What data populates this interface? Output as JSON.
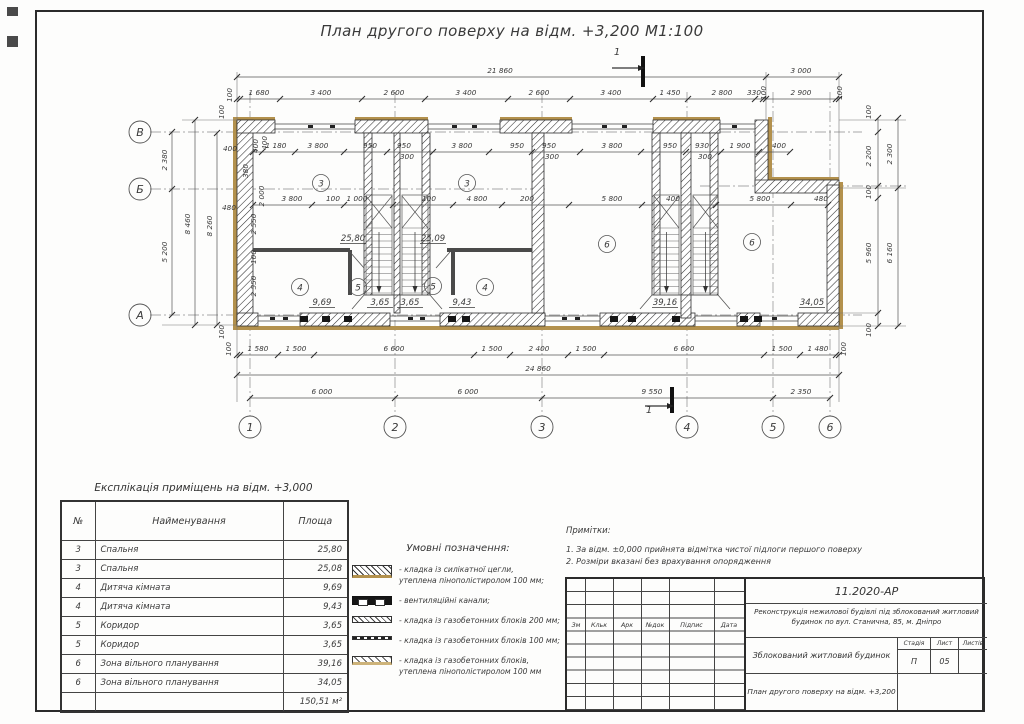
{
  "sheet": {
    "title": "План другого поверху на відм. +3,200 М1:100"
  },
  "plan": {
    "axes_bottom": [
      [
        "1",
        250
      ],
      [
        "2",
        395
      ],
      [
        "3",
        542
      ],
      [
        "4",
        687
      ],
      [
        "5",
        773
      ],
      [
        "6",
        830
      ]
    ],
    "axes_left": [
      [
        "В",
        132
      ],
      [
        "Б",
        189
      ],
      [
        "А",
        315
      ]
    ],
    "room_tags": [
      [
        "3",
        321,
        183
      ],
      [
        "3",
        467,
        183
      ],
      [
        "4",
        300,
        287
      ],
      [
        "5",
        358,
        287
      ],
      [
        "5",
        433,
        286
      ],
      [
        "4",
        485,
        287
      ],
      [
        "6",
        607,
        244
      ],
      [
        "6",
        752,
        242
      ]
    ],
    "area_labels": [
      [
        "25,80",
        353,
        241
      ],
      [
        "25,09",
        433,
        241
      ],
      [
        "9,69",
        322,
        305
      ],
      [
        "3,65",
        380,
        305
      ],
      [
        "3,65",
        410,
        305
      ],
      [
        "9,43",
        462,
        305
      ],
      [
        "39,16",
        665,
        305
      ],
      [
        "34,05",
        812,
        305
      ]
    ],
    "section_labels": [
      [
        "1",
        617,
        55
      ],
      [
        "1",
        649,
        413
      ]
    ],
    "dim_labels": [
      [
        "21 860",
        500,
        73,
        0
      ],
      [
        "3 000",
        801,
        73,
        0
      ],
      [
        "100",
        232,
        95,
        1
      ],
      [
        "1 680",
        259,
        95,
        0
      ],
      [
        "3 400",
        321,
        95,
        0
      ],
      [
        "2 600",
        394,
        95,
        0
      ],
      [
        "3 400",
        466,
        95,
        0
      ],
      [
        "2 600",
        539,
        95,
        0
      ],
      [
        "3 400",
        611,
        95,
        0
      ],
      [
        "1 450",
        670,
        95,
        0
      ],
      [
        "2 800",
        722,
        95,
        0
      ],
      [
        "330",
        754,
        95,
        0
      ],
      [
        "100",
        766,
        93,
        1
      ],
      [
        "2 900",
        801,
        95,
        0
      ],
      [
        "100",
        842,
        93,
        1
      ],
      [
        "400",
        258,
        146,
        1
      ],
      [
        "1 180",
        276,
        148,
        0
      ],
      [
        "3 800",
        318,
        148,
        0
      ],
      [
        "950",
        370,
        148,
        0
      ],
      [
        "950",
        404,
        148,
        0
      ],
      [
        "300",
        407,
        159,
        0
      ],
      [
        "3 800",
        462,
        148,
        0
      ],
      [
        "950",
        517,
        148,
        0
      ],
      [
        "950",
        549,
        148,
        0
      ],
      [
        "300",
        552,
        159,
        0
      ],
      [
        "3 800",
        612,
        148,
        0
      ],
      [
        "950",
        670,
        148,
        0
      ],
      [
        "930",
        702,
        148,
        0
      ],
      [
        "300",
        705,
        159,
        0
      ],
      [
        "1 900",
        740,
        148,
        0
      ],
      [
        "400",
        779,
        148,
        0
      ],
      [
        "3 800",
        292,
        201,
        0
      ],
      [
        "100",
        333,
        201,
        0
      ],
      [
        "1 000",
        357,
        201,
        0
      ],
      [
        "100",
        429,
        201,
        0
      ],
      [
        "4 800",
        477,
        201,
        0
      ],
      [
        "200",
        527,
        201,
        0
      ],
      [
        "5 800",
        612,
        201,
        0
      ],
      [
        "400",
        673,
        201,
        0
      ],
      [
        "5 800",
        760,
        201,
        0
      ],
      [
        "480",
        821,
        201,
        0
      ],
      [
        "100",
        231,
        349,
        1
      ],
      [
        "1 580",
        258,
        351,
        0
      ],
      [
        "1 500",
        296,
        351,
        0
      ],
      [
        "6 600",
        394,
        351,
        0
      ],
      [
        "1 500",
        492,
        351,
        0
      ],
      [
        "2 400",
        539,
        351,
        0
      ],
      [
        "1 500",
        586,
        351,
        0
      ],
      [
        "6 600",
        684,
        351,
        0
      ],
      [
        "1 500",
        782,
        351,
        0
      ],
      [
        "1 480",
        818,
        351,
        0
      ],
      [
        "100",
        846,
        349,
        1
      ],
      [
        "24 860",
        538,
        371,
        0
      ],
      [
        "6 000",
        322,
        394,
        0
      ],
      [
        "6 000",
        468,
        394,
        0
      ],
      [
        "9 550",
        652,
        394,
        0
      ],
      [
        "2 350",
        801,
        394,
        0
      ],
      [
        "2 380",
        167,
        160,
        1
      ],
      [
        "5 200",
        167,
        252,
        1
      ],
      [
        "8 460",
        190,
        224,
        1
      ],
      [
        "8 260",
        212,
        226,
        1
      ],
      [
        "100",
        224,
        112,
        1
      ],
      [
        "100",
        224,
        332,
        1
      ],
      [
        "400",
        230,
        151,
        0
      ],
      [
        "480",
        229,
        210,
        0
      ],
      [
        "2 550",
        256,
        224,
        1
      ],
      [
        "100",
        256,
        257,
        1
      ],
      [
        "2 550",
        256,
        286,
        1
      ],
      [
        "2 000",
        264,
        196,
        1
      ],
      [
        "380",
        248,
        171,
        1
      ],
      [
        "400",
        267,
        143,
        1
      ],
      [
        "100",
        871,
        112,
        1
      ],
      [
        "2 200",
        871,
        156,
        1
      ],
      [
        "2 300",
        892,
        154,
        1
      ],
      [
        "100",
        871,
        192,
        1
      ],
      [
        "5 960",
        871,
        253,
        1
      ],
      [
        "6 160",
        892,
        253,
        1
      ],
      [
        "100",
        871,
        330,
        1
      ]
    ]
  },
  "explication": {
    "title": "Експлікація приміщень на відм. +3,000",
    "headers": [
      "№",
      "Найменування",
      "Площа"
    ],
    "rows": [
      [
        "3",
        "Спальня",
        "25,80"
      ],
      [
        "3",
        "Спальня",
        "25,08"
      ],
      [
        "4",
        "Дитяча кімната",
        "9,69"
      ],
      [
        "4",
        "Дитяча кімната",
        "9,43"
      ],
      [
        "5",
        "Коридор",
        "3,65"
      ],
      [
        "5",
        "Коридор",
        "3,65"
      ],
      [
        "6",
        "Зона вільного планування",
        "39,16"
      ],
      [
        "6",
        "Зона вільного планування",
        "34,05"
      ]
    ],
    "total": "150,51 м²"
  },
  "legend": {
    "title": "Умовні позначення:",
    "items": [
      {
        "swatch": "brick",
        "text": "- кладка із силікатної цегли,\nутеплена пінополістиролом 100 мм;"
      },
      {
        "swatch": "vent",
        "text": "- вентиляційні канали;"
      },
      {
        "swatch": "block200",
        "text": "- кладка із газобетонних блоків 200 мм;"
      },
      {
        "swatch": "block100",
        "text": "- кладка із газобетонних блоків 100 мм;"
      },
      {
        "swatch": "block-insulated",
        "text": "- кладка із газобетонних блоків,\nутеплена пінополістиролом 100 мм"
      }
    ]
  },
  "notes": {
    "title": "Примітки:",
    "lines": "1. За відм. ±0,000 прийнята відмітка чистої підлоги першого поверху\n2. Розміри вказані без врахування опорядження"
  },
  "titleblock": {
    "doc_number": "11.2020-АР",
    "project": "Реконструкція нежилової будівлі під зблокований житловий будинок по вул. Станична, 85, м. Дніпро",
    "object": "Зблокований житловий будинок",
    "sheet_caption": "План другого поверху на відм. +3,200 М1:100",
    "cols": [
      "Зм",
      "Кльк",
      "Арк",
      "№док",
      "Підпис",
      "Дата"
    ],
    "stage_label": "Стадія",
    "sheet_label": "Лист",
    "sheets_label": "Листів",
    "stage": "П",
    "sheet_no": "05",
    "sheets_total": ""
  }
}
